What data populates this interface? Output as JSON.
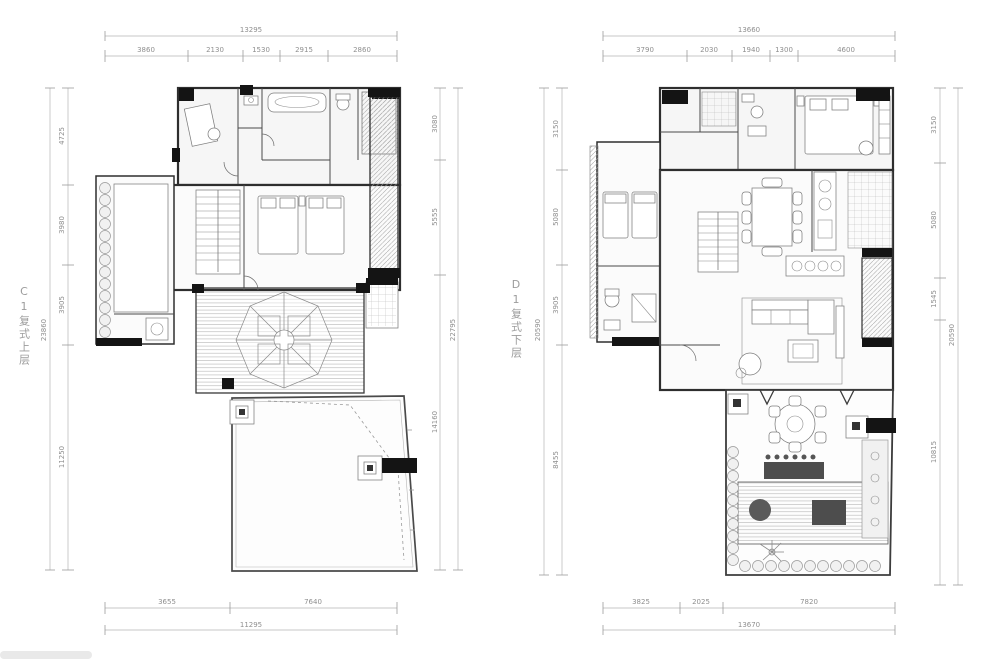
{
  "page": {
    "background": "#ffffff"
  },
  "plans": {
    "left": {
      "label": "C1复式上层",
      "dims": {
        "top": {
          "total": "13295",
          "segments": [
            "3860",
            "2130",
            "1530",
            "2915",
            "2860"
          ]
        },
        "bottom": {
          "segments": [
            "3655",
            "7640"
          ],
          "total": "11295"
        },
        "left": {
          "segments": [
            "4725",
            "3980",
            "3905",
            "11250"
          ],
          "total": "23860"
        },
        "right": {
          "segments": [
            "3080",
            "5555",
            "14160"
          ],
          "total": "22795"
        }
      }
    },
    "right": {
      "label": "D1复式下层",
      "dims": {
        "top": {
          "total": "13660",
          "segments": [
            "3790",
            "2030",
            "1940",
            "1300",
            "4600"
          ]
        },
        "bottom": {
          "segments": [
            "3825",
            "2025",
            "7820"
          ],
          "total": "13670"
        },
        "left": {
          "segments": [
            "3150",
            "5080",
            "3905",
            "8455"
          ],
          "total": "20590"
        },
        "right": {
          "segments": [
            "3150",
            "5080",
            "1545",
            "10815"
          ],
          "total": "20590"
        }
      }
    }
  }
}
